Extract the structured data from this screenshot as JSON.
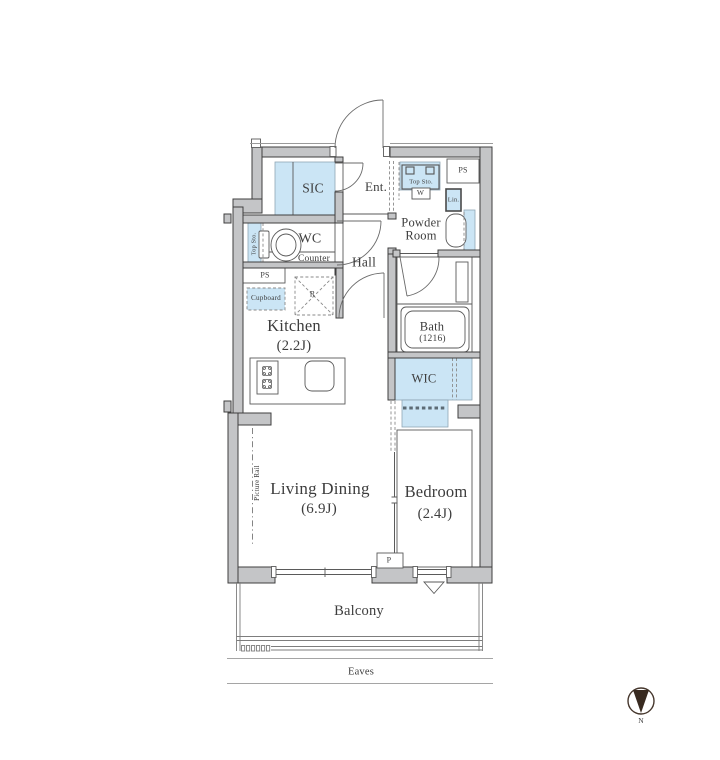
{
  "floor_plan": {
    "labels": {
      "sic": "SIC",
      "entrance": "Ent.",
      "wc": "WC",
      "wc_counter": "Counter",
      "hall": "Hall",
      "wc_top_storage": "Top Sto.",
      "laundry_top_storage": "Top Sto.",
      "washer": "W",
      "ps_upper": "PS",
      "ps_kitchen": "PS",
      "linen": "Lin.",
      "powder_room": "Powder Room",
      "cupboard": "Cupboard",
      "refrigerator_space": "R",
      "kitchen_name": "Kitchen",
      "kitchen_size": "(2.2J)",
      "bath_name": "Bath",
      "bath_size": "(1216)",
      "wic": "WIC",
      "living_name": "Living Dining",
      "living_size": "(6.9J)",
      "bedroom_name": "Bedroom",
      "bedroom_size": "(2.4J)",
      "pillar": "P",
      "picture_rail": "Picture Rail",
      "balcony": "Balcony",
      "eaves": "Eaves",
      "compass_north": "N"
    },
    "colors": {
      "wall_fill": "#c4c5c7",
      "wall_outline": "#3f3f3f",
      "highlight_blue": "#cbe5f5",
      "line_gray": "#666666",
      "text": "#3d3d3d"
    }
  }
}
